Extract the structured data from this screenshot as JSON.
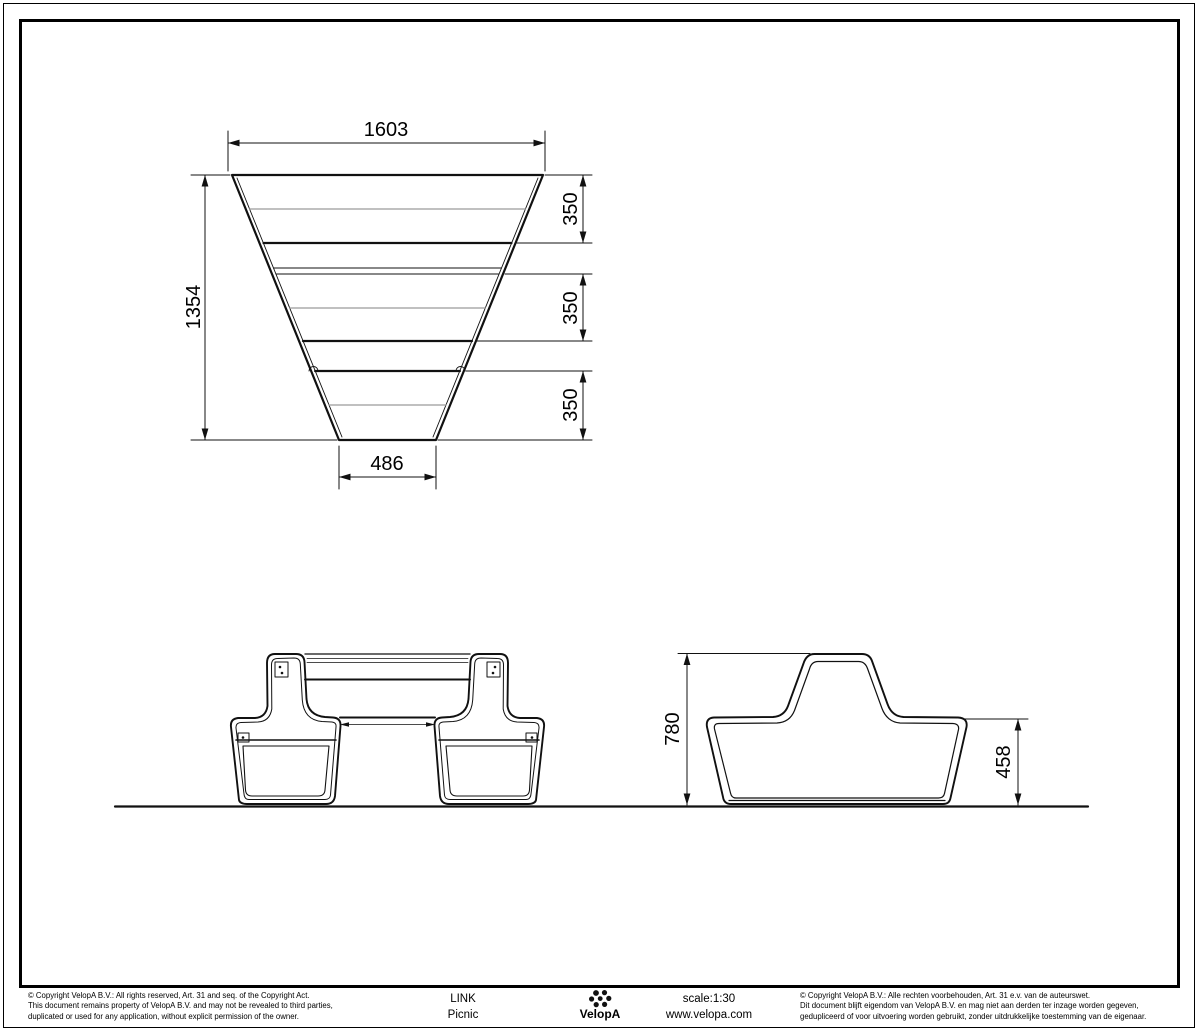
{
  "top_view": {
    "dim_width_top": "1603",
    "dim_height": "1354",
    "dim_width_bottom": "486",
    "dim_seg": [
      "350",
      "350",
      "350"
    ]
  },
  "side_view": {
    "dim_total_height": "780",
    "dim_seat_height": "458"
  },
  "footer": {
    "copyright_en_lines": [
      "©  Copyright VelopA B.V.: All rights reserved, Art. 31 and seq. of the Copyright Act.",
      "This document remains property of VelopA B.V. and may not be revealed to third parties,",
      "duplicated or used for any application, without explicit permission of the owner."
    ],
    "copyright_nl_lines": [
      "©  Copyright VelopA B.V.: Alle rechten voorbehouden, Art. 31 e.v. van de auteurswet.",
      "Dit document blijft eigendom van VelopA B.V. en mag niet aan derden ter inzage worden gegeven,",
      "gedupliceerd of voor uitvoering worden gebruikt, zonder uitdrukkelijke toestemming van de eigenaar."
    ],
    "product_name": "LINK",
    "product_variant": "Picnic",
    "brand": "VelopA",
    "scale_label": "scale:1:30",
    "website": "www.velopa.com"
  },
  "colors": {
    "line": "#111111",
    "gray_line": "#9a9a9a",
    "background": "#ffffff"
  }
}
